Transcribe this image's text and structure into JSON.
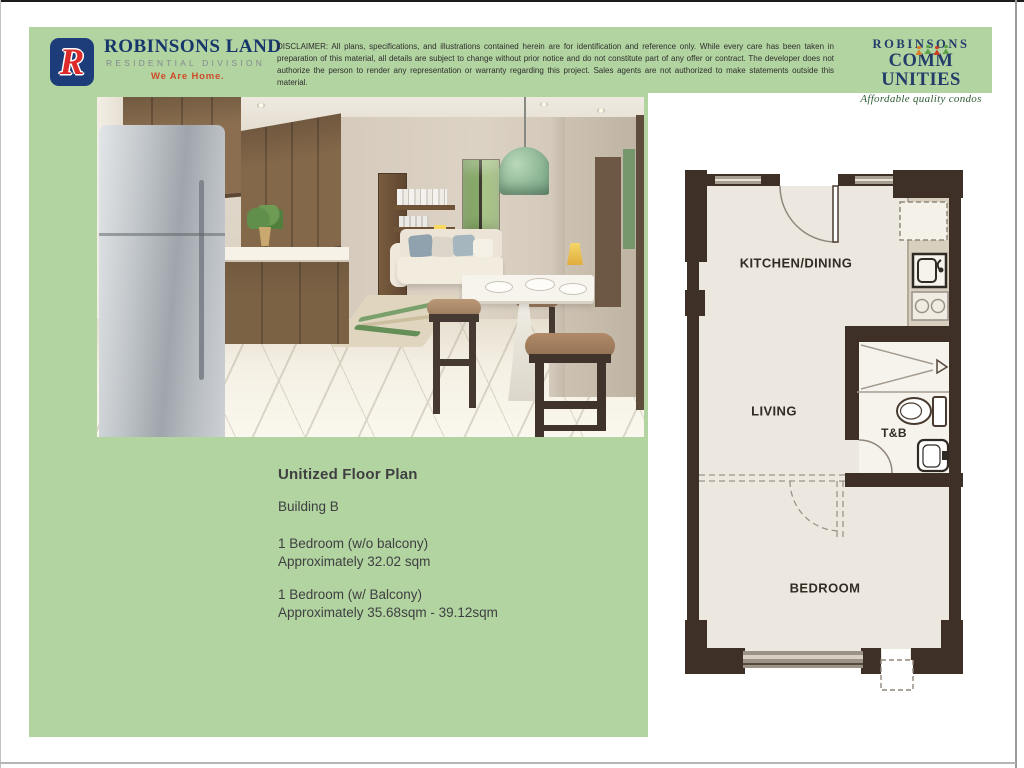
{
  "header": {
    "brand": {
      "logo_letter": "R",
      "name": "ROBINSONS LAND",
      "division": "RESIDENTIAL DIVISION",
      "tagline": "We Are Home."
    },
    "disclaimer": "DISCLAIMER: All plans, specifications, and illustrations contained herein are for identification and reference only. While every care has been taken in preparation of this material, all details are subject to change without prior notice and do not constitute part of any offer or contract. The developer does not authorize the person to render any representation or warranty regarding this project. Sales agents are not authorized to make statements outside this material.",
    "communities": {
      "line1": "ROBINSONS",
      "line2_pre": "CO",
      "line2_mid": "MM",
      "line2_post": "UNITIES",
      "tagline": "Affordable quality condos"
    }
  },
  "unit_info": {
    "title": "Unitized Floor Plan",
    "building": "Building B",
    "options": [
      {
        "name": "1 Bedroom (w/o balcony)",
        "area": "Approximately 32.02 sqm"
      },
      {
        "name": "1 Bedroom (w/ Balcony)",
        "area": "Approximately 35.68sqm - 39.12sqm"
      }
    ]
  },
  "floorplan": {
    "labels": {
      "kitchen": "KITCHEN/DINING",
      "living": "LIVING",
      "tnb": "T&B",
      "bedroom": "BEDROOM"
    }
  },
  "colors": {
    "panel_green": "#b2d4a1",
    "brand_navy": "#1d3d7a",
    "brand_red": "#dd2b2b",
    "tagline_red": "#cf4a2a",
    "wall_brown": "#3e3027",
    "script_green": "#2f5e35"
  }
}
